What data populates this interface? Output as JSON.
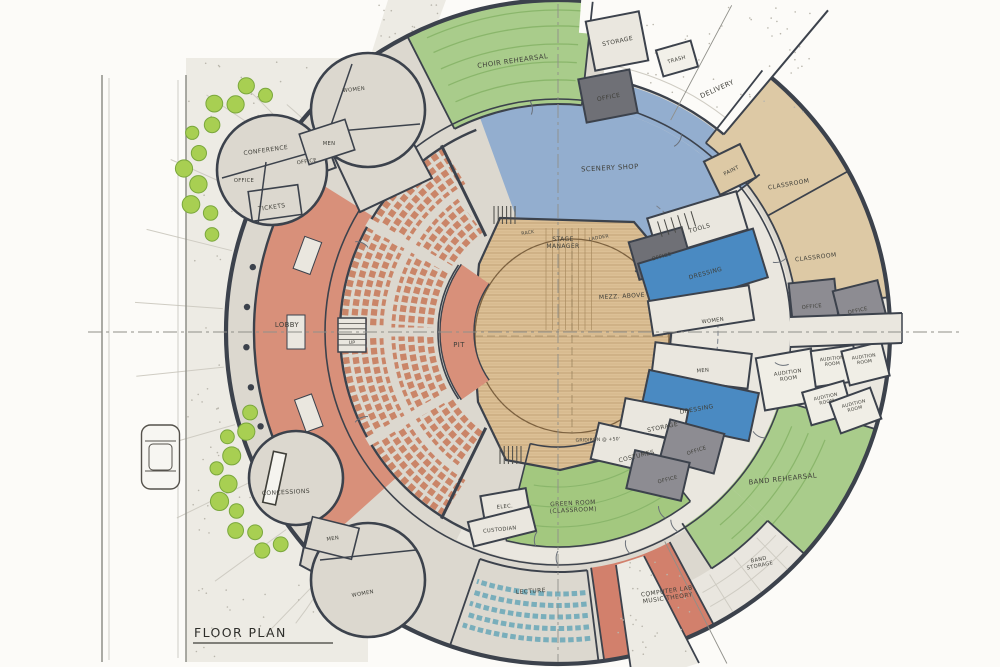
{
  "title": "FLOOR PLAN",
  "rooms": {
    "choir_rehearsal": "CHOIR REHEARSAL",
    "storage_top": "STORAGE",
    "trash": "TRASH",
    "delivery": "DELIVERY",
    "office_scenery": "OFFICE",
    "scenery_shop": "SCENERY SHOP",
    "paint": "PAINT",
    "classroom_upper": "CLASSROOM",
    "classroom_lower": "CLASSROOM",
    "tools": "TOOLS",
    "office_stage_right": "OFFICE",
    "dressing_upper": "DRESSING",
    "women_stage": "WOMEN",
    "mezz_above": "MEZZ. ABOVE",
    "stage_manager": "STAGE\nMANAGER",
    "rack": "RACK",
    "ladder": "LADDER",
    "gridiron": "GRIDIRON @ +50'",
    "pit": "PIT",
    "lobby": "LOBBY",
    "up": "UP",
    "conference": "CONFERENCE",
    "office_conf_1": "OFFICE",
    "office_conf_2": "OFFICE",
    "tickets": "TICKETS",
    "women_nw": "WOMEN",
    "men_nw": "MEN",
    "concessions": "CONCESSIONS",
    "men_sw": "MEN",
    "women_sw": "WOMEN",
    "elec": "ELEC.",
    "custodian": "CUSTODIAN",
    "green_room": "GREEN ROOM\n(CLASSROOM)",
    "costumes": "COSTUMES",
    "storage_lower": "STORAGE",
    "office_low_1": "OFFICE",
    "office_low_2": "OFFICE",
    "men_se": "MEN",
    "dressing_lower": "DRESSING",
    "office_east_1": "OFFICE",
    "office_east_2": "OFFICE",
    "audition_1": "AUDITION\nROOM",
    "audition_2": "AUDITION\nROOM",
    "audition_3": "AUDITION\nROOM",
    "audition_4": "AUDITION\nROOM",
    "audition_5": "AUDITION\nROOM",
    "band_rehearsal": "BAND REHEARSAL",
    "band_storage": "BAND\nSTORAGE",
    "computer_lab": "COMPUTER LAB\nMUSIC THEORY",
    "lecture": "LECTURE"
  },
  "palette": {
    "bg": "#fcfbf8",
    "plaza": "#edebe4",
    "floor": "#dcd8cf",
    "floorLight": "#eae7df",
    "roomLight": "#f0eee6",
    "wall": "#3c424c",
    "wallLight": "#6a7079",
    "ink": "#3f3f39",
    "green": "#a9cc8b",
    "greenDark": "#8ab66b",
    "greenRoom": "#a3c87f",
    "blueShop": "#93aecf",
    "blueDress": "#4a8ac2",
    "tan": "#ddc9a5",
    "grayOffice": "#8d8c92",
    "grayDark": "#6f7076",
    "salmon": "#d8907a",
    "compLab": "#d2806c",
    "seat": "#ca8568",
    "tealSeat": "#79aebb",
    "wood": "#dcc096",
    "woodLine": "#c2a277",
    "shrub": "#a8cf52",
    "shrubDark": "#7aa73c",
    "road": "#8f8f88",
    "joint": "#cfccc3",
    "speckle": "#b9b6ac",
    "centerline": "#8f8f89",
    "bandStorageFill": "#e9e6df"
  }
}
